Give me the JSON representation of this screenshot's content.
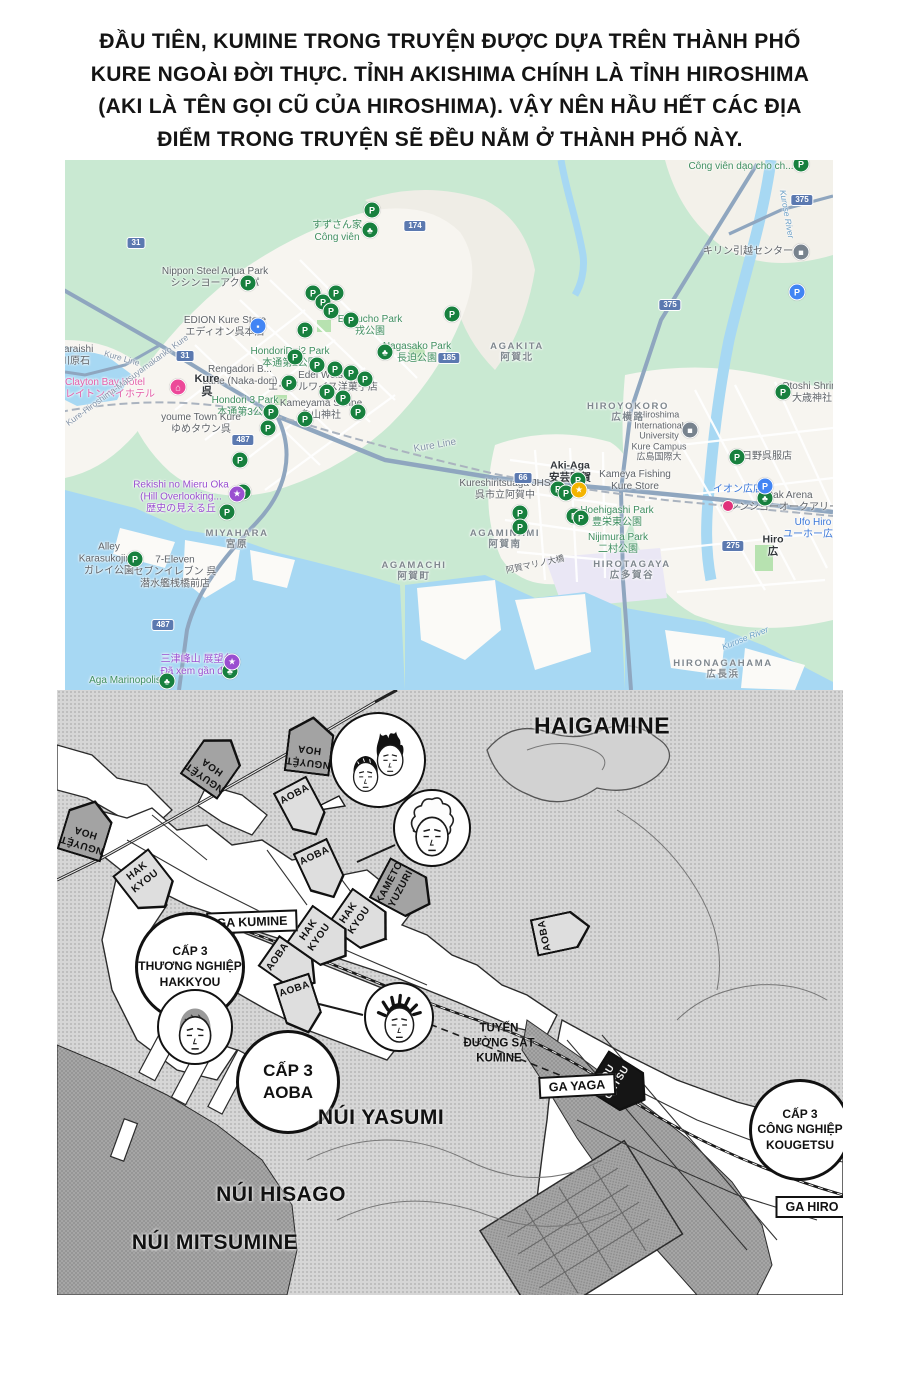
{
  "intro": {
    "lines": [
      "ĐẦU TIÊN, KUMINE TRONG TRUYỆN ĐƯỢC DỰA TRÊN THÀNH PHỐ",
      "KURE NGOÀI ĐỜI THỰC. TỈNH AKISHIMA CHÍNH LÀ TỈNH HIROSHIMA",
      "(AKI LÀ TÊN GỌI CŨ CỦA HIROSHIMA). VẬY NÊN HẦU HẾT CÁC ĐỊA",
      "ĐIỂM TRONG TRUYỆN SẼ ĐỀU NẰM Ở THÀNH PHỐ NÀY."
    ]
  },
  "gmap": {
    "colors": {
      "vegetation": "#c9e9d2",
      "water": "#a7d8f3",
      "urban": "#f7f5f0",
      "highway": "#8fa6bf",
      "park_pin": "#17803e",
      "visited": "#9a4fd0",
      "business": "#5f6368"
    },
    "pin_glyphs": {
      "p": "P",
      "tree": "♣",
      "star": "★",
      "lock": "▪",
      "hotel": "⌂",
      "gray": "■",
      "school": "■",
      "bp": "P",
      "mag": "",
      "purple": "★"
    },
    "labels": [
      {
        "x": 676,
        "y": 7,
        "c": "green",
        "lines": [
          "Công viên dạo cho ch..."
        ]
      },
      {
        "x": 272,
        "y": 72,
        "c": "green",
        "lines": [
          "すずさん家",
          "Công viên"
        ]
      },
      {
        "x": 150,
        "y": 118,
        "c": "gray",
        "lines": [
          "Nippon Steel Aqua Park",
          "シシンヨーアクアパ"
        ]
      },
      {
        "x": 160,
        "y": 167,
        "c": "gray",
        "lines": [
          "EDION Kure Store",
          "エディオン呉本店"
        ]
      },
      {
        "x": 305,
        "y": 166,
        "c": "green",
        "lines": [
          "Ebisucho Park",
          "戎公園"
        ]
      },
      {
        "x": 352,
        "y": 193,
        "c": "green",
        "lines": [
          "Nagasako Park",
          "長迫公園"
        ]
      },
      {
        "x": 225,
        "y": 198,
        "c": "green",
        "lines": [
          "HondoriDai2 Park",
          "本通第2公園"
        ]
      },
      {
        "x": 175,
        "y": 216,
        "c": "gray",
        "lines": [
          "Rengadori B...",
          "Lane (Naka-dori)"
        ]
      },
      {
        "x": 258,
        "y": 222,
        "c": "gray",
        "lines": [
          "Edel Weiss",
          "エーデルワイス洋菓子店"
        ]
      },
      {
        "x": 142,
        "y": 226,
        "c": "dark",
        "s": 11,
        "lines": [
          "Kure",
          "呉"
        ]
      },
      {
        "x": 40,
        "y": 229,
        "c": "pink",
        "lines": [
          "Clayton Bay Hotel",
          "クレイトンベイホテル"
        ]
      },
      {
        "x": 180,
        "y": 247,
        "c": "green",
        "lines": [
          "Hondori 3 Park",
          "本通第3公園"
        ]
      },
      {
        "x": 256,
        "y": 250,
        "c": "gray",
        "lines": [
          "Kameyama Shrine",
          "亀山神社"
        ]
      },
      {
        "x": 136,
        "y": 264,
        "c": "gray",
        "lines": [
          "youme Town Kure",
          "ゆめタウン呉"
        ]
      },
      {
        "x": 370,
        "y": 286,
        "r": -10,
        "c": "road",
        "lines": [
          "Kure Line"
        ]
      },
      {
        "x": 57,
        "y": 198,
        "r": 16,
        "c": "road",
        "s": 8.5,
        "lines": [
          "Kure Line"
        ]
      },
      {
        "x": 116,
        "y": 337,
        "c": "purple",
        "lines": [
          "Rekishi no Mieru Oka",
          "(Hill Overlooking...",
          "歴史の見える丘"
        ]
      },
      {
        "x": 172,
        "y": 379,
        "c": "area",
        "ls": 1,
        "lines": [
          "MIYAHARA",
          "宮原"
        ]
      },
      {
        "x": 44,
        "y": 399,
        "c": "gray",
        "lines": [
          "Alley",
          "Karasukojima",
          "ガレイ公園"
        ]
      },
      {
        "x": 110,
        "y": 412,
        "c": "gray",
        "lines": [
          "7-Eleven",
          "セブンイレブン 呉",
          "潜水艦桟橋前店"
        ]
      },
      {
        "x": 349,
        "y": 411,
        "c": "area",
        "ls": 1,
        "lines": [
          "AGAMACHI",
          "阿賀町"
        ]
      },
      {
        "x": 132,
        "y": 506,
        "c": "purple",
        "lines": [
          "三津峰山 展望台",
          "Đã xem gần đây"
        ]
      },
      {
        "x": 60,
        "y": 521,
        "c": "green",
        "lines": [
          "Aga Marinopolis"
        ]
      },
      {
        "x": 452,
        "y": 192,
        "c": "area",
        "ls": 1,
        "lines": [
          "AGAKITA",
          "阿賀北"
        ]
      },
      {
        "x": 683,
        "y": 92,
        "c": "gray",
        "lines": [
          "キリン引越センター"
        ]
      },
      {
        "x": 594,
        "y": 276,
        "c": "gray",
        "s": 9,
        "lines": [
          "Hiroshima",
          "International",
          "University",
          "Kure Campus",
          "広島国際大"
        ]
      },
      {
        "x": 505,
        "y": 312,
        "c": "dark",
        "s": 10.5,
        "lines": [
          "Aki-Aga",
          "安芸阿賀"
        ]
      },
      {
        "x": 440,
        "y": 330,
        "c": "gray",
        "lines": [
          "Kureshiritsuaga JHS",
          "呉市立阿賀中"
        ]
      },
      {
        "x": 570,
        "y": 321,
        "c": "gray",
        "lines": [
          "Kameya Fishing",
          "Kure Store"
        ]
      },
      {
        "x": 440,
        "y": 379,
        "c": "area",
        "ls": 1,
        "lines": [
          "AGAMINAMI",
          "阿賀南"
        ]
      },
      {
        "x": 552,
        "y": 357,
        "c": "green",
        "lines": [
          "Hoehigashi Park",
          "豊栄東公園"
        ]
      },
      {
        "x": 553,
        "y": 384,
        "c": "green",
        "lines": [
          "Nijimura Park",
          "二村公園"
        ]
      },
      {
        "x": 567,
        "y": 410,
        "c": "area",
        "ls": 1,
        "lines": [
          "HIROTAGAYA",
          "広多賀谷"
        ]
      },
      {
        "x": 702,
        "y": 297,
        "c": "gray",
        "lines": [
          "日野呉服店"
        ]
      },
      {
        "x": 673,
        "y": 330,
        "c": "blue",
        "lines": [
          "イオン広店"
        ]
      },
      {
        "x": 724,
        "y": 342,
        "c": "gray",
        "lines": [
          "Oak Arena",
          "シンシヨーオークアリーナ"
        ]
      },
      {
        "x": 748,
        "y": 369,
        "c": "blue",
        "lines": [
          "Ufo Hiro",
          "ユーホー広店"
        ]
      },
      {
        "x": 708,
        "y": 386,
        "c": "dark",
        "s": 10.5,
        "lines": [
          "Hiro",
          "広"
        ]
      },
      {
        "x": 747,
        "y": 233,
        "c": "gray",
        "lines": [
          "Otoshi Shrine",
          "大歳神社"
        ]
      },
      {
        "x": 563,
        "y": 252,
        "c": "area",
        "ls": 1,
        "lines": [
          "HIROYOKORO",
          "広横路"
        ]
      },
      {
        "x": 658,
        "y": 509,
        "c": "area",
        "ls": 1,
        "lines": [
          "HIRONAGAHAMA",
          "広長浜"
        ]
      },
      {
        "x": 10,
        "y": 196,
        "c": "gray",
        "lines": [
          "waraishi",
          "川原石"
        ]
      },
      {
        "x": 62,
        "y": 220,
        "r": -36,
        "c": "road",
        "s": 8.5,
        "lines": [
          "Kure-Hiroshima-Matsuyamakanko Kure"
        ]
      },
      {
        "x": 470,
        "y": 404,
        "r": -12,
        "c": "gray",
        "s": 8.5,
        "lines": [
          "阿賀マリノ大橋"
        ]
      },
      {
        "x": 722,
        "y": 54,
        "r": 80,
        "c": "waterl",
        "s": 8.5,
        "lines": [
          "Kurose River"
        ]
      },
      {
        "x": 680,
        "y": 478,
        "r": -22,
        "c": "waterl",
        "s": 8.5,
        "lines": [
          "Kurose River"
        ]
      }
    ],
    "pins": [
      {
        "t": "p",
        "x": 183,
        "y": 123
      },
      {
        "t": "p",
        "x": 736,
        "y": 4
      },
      {
        "t": "p",
        "x": 307,
        "y": 50
      },
      {
        "t": "p",
        "x": 248,
        "y": 133
      },
      {
        "t": "p",
        "x": 258,
        "y": 142
      },
      {
        "t": "p",
        "x": 266,
        "y": 151
      },
      {
        "t": "p",
        "x": 271,
        "y": 133
      },
      {
        "t": "p",
        "x": 286,
        "y": 160
      },
      {
        "t": "p",
        "x": 240,
        "y": 170
      },
      {
        "t": "p",
        "x": 230,
        "y": 197
      },
      {
        "t": "p",
        "x": 252,
        "y": 205
      },
      {
        "t": "p",
        "x": 270,
        "y": 209
      },
      {
        "t": "p",
        "x": 286,
        "y": 213
      },
      {
        "t": "p",
        "x": 300,
        "y": 219
      },
      {
        "t": "p",
        "x": 224,
        "y": 223
      },
      {
        "t": "p",
        "x": 262,
        "y": 232
      },
      {
        "t": "p",
        "x": 278,
        "y": 238
      },
      {
        "t": "p",
        "x": 206,
        "y": 252
      },
      {
        "t": "p",
        "x": 240,
        "y": 259
      },
      {
        "t": "p",
        "x": 293,
        "y": 252
      },
      {
        "t": "p",
        "x": 203,
        "y": 268
      },
      {
        "t": "p",
        "x": 175,
        "y": 300
      },
      {
        "t": "p",
        "x": 178,
        "y": 332
      },
      {
        "t": "p",
        "x": 162,
        "y": 352
      },
      {
        "t": "p",
        "x": 70,
        "y": 399
      },
      {
        "t": "p",
        "x": 387,
        "y": 154
      },
      {
        "t": "p",
        "x": 513,
        "y": 320
      },
      {
        "t": "p",
        "x": 493,
        "y": 329
      },
      {
        "t": "p",
        "x": 501,
        "y": 333
      },
      {
        "t": "p",
        "x": 455,
        "y": 353
      },
      {
        "t": "p",
        "x": 455,
        "y": 367
      },
      {
        "t": "p",
        "x": 509,
        "y": 356
      },
      {
        "t": "p",
        "x": 516,
        "y": 358
      },
      {
        "t": "p",
        "x": 672,
        "y": 297
      },
      {
        "t": "p",
        "x": 718,
        "y": 232
      },
      {
        "t": "tree",
        "x": 305,
        "y": 70
      },
      {
        "t": "tree",
        "x": 320,
        "y": 192
      },
      {
        "t": "tree",
        "x": 700,
        "y": 338
      },
      {
        "t": "tree",
        "x": 102,
        "y": 521
      },
      {
        "t": "tree",
        "x": 165,
        "y": 511
      },
      {
        "t": "star",
        "x": 514,
        "y": 330
      },
      {
        "t": "lock",
        "x": 193,
        "y": 166
      },
      {
        "t": "hotel",
        "x": 113,
        "y": 227
      },
      {
        "t": "gray",
        "x": 736,
        "y": 92
      },
      {
        "t": "school",
        "x": 625,
        "y": 270
      },
      {
        "t": "bp",
        "x": 700,
        "y": 326
      },
      {
        "t": "bp",
        "x": 732,
        "y": 132
      },
      {
        "t": "mag",
        "x": 663,
        "y": 346
      },
      {
        "t": "purple",
        "x": 172,
        "y": 334
      },
      {
        "t": "purple",
        "x": 167,
        "y": 502
      }
    ],
    "shields": [
      {
        "n": "31",
        "x": 71,
        "y": 83
      },
      {
        "n": "174",
        "x": 350,
        "y": 66
      },
      {
        "n": "375",
        "x": 737,
        "y": 40
      },
      {
        "n": "375",
        "x": 605,
        "y": 145
      },
      {
        "n": "185",
        "x": 384,
        "y": 198
      },
      {
        "n": "31",
        "x": 120,
        "y": 196
      },
      {
        "n": "487",
        "x": 178,
        "y": 280
      },
      {
        "n": "487",
        "x": 98,
        "y": 465
      },
      {
        "n": "275",
        "x": 668,
        "y": 386
      },
      {
        "n": "66",
        "x": 458,
        "y": 318
      }
    ]
  },
  "manga": {
    "mountains": [
      {
        "text": "HAIGAMINE",
        "x": 545,
        "y": 36,
        "s": 23
      },
      {
        "text": "NÚI YASUMI",
        "x": 324,
        "y": 428,
        "s": 21
      },
      {
        "text": "NÚI HISAGO",
        "x": 224,
        "y": 505,
        "s": 21
      },
      {
        "text": "NÚI MITSUMINE",
        "x": 158,
        "y": 553,
        "s": 21
      }
    ],
    "pennants": [
      {
        "lines": [
          "NGUYỆT",
          "HOA"
        ],
        "x": 253,
        "y": 55,
        "rot": 187,
        "tone": "mid"
      },
      {
        "lines": [
          "NGUYỆT",
          "HOA"
        ],
        "x": 158,
        "y": 73,
        "rot": 215,
        "tone": "mid"
      },
      {
        "lines": [
          "NGUYỆT",
          "HOA"
        ],
        "x": 30,
        "y": 138,
        "rot": 197,
        "tone": "mid"
      },
      {
        "lines": [
          "AOBA"
        ],
        "x": 246,
        "y": 120,
        "rot": -28,
        "tone": "light"
      },
      {
        "lines": [
          "AOBA"
        ],
        "x": 265,
        "y": 182,
        "rot": -25,
        "tone": "light"
      },
      {
        "lines": [
          "AOBA"
        ],
        "x": 505,
        "y": 242,
        "rot": 258,
        "tone": "light"
      },
      {
        "lines": [
          "AOBA"
        ],
        "x": 235,
        "y": 277,
        "rot": -55,
        "tone": "light"
      },
      {
        "lines": [
          "AOBA"
        ],
        "x": 243,
        "y": 316,
        "rot": -18,
        "tone": "light"
      },
      {
        "lines": [
          "HAK",
          "KYOU"
        ],
        "x": 91,
        "y": 195,
        "rot": -38,
        "tone": "light"
      },
      {
        "lines": [
          "HAK",
          "KYOU"
        ],
        "x": 306,
        "y": 233,
        "rot": -55,
        "tone": "light"
      },
      {
        "lines": [
          "HAK",
          "KYOU"
        ],
        "x": 266,
        "y": 250,
        "rot": -55,
        "tone": "light"
      },
      {
        "lines": [
          "KAMETO",
          "YUZURI"
        ],
        "x": 348,
        "y": 201,
        "rot": -62,
        "tone": "mid"
      },
      {
        "lines": [
          "KOU",
          "GETSU"
        ],
        "x": 564,
        "y": 395,
        "rot": -58,
        "tone": "black"
      }
    ],
    "signs": [
      {
        "text": "GA KUMINE",
        "x": 195,
        "y": 232,
        "rot": -2
      },
      {
        "text": "GA YAGA",
        "x": 520,
        "y": 396,
        "rot": -3
      },
      {
        "text": "GA HIRO",
        "x": 755,
        "y": 517,
        "rot": 0
      }
    ],
    "schools": [
      {
        "lines": [
          "CẤP 3",
          "THƯƠNG NGHIỆP",
          "HAKKYOU"
        ],
        "x": 133,
        "y": 277,
        "r": 52,
        "fs": 12
      },
      {
        "lines": [
          "CẤP 3",
          "AOBA"
        ],
        "x": 231,
        "y": 392,
        "r": 49,
        "fs": 17
      },
      {
        "lines": [
          "CẤP 3",
          "CÔNG NGHIỆP",
          "KOUGETSU"
        ],
        "x": 743,
        "y": 440,
        "r": 48,
        "fs": 12
      }
    ],
    "note": {
      "lines": [
        "TUYẾN",
        "ĐƯỜNG SẮT",
        "KUMINE"
      ],
      "x": 442,
      "y": 354
    },
    "faces": [
      {
        "variant": "duo",
        "x": 321,
        "y": 70,
        "r": 46
      },
      {
        "variant": "curly",
        "x": 375,
        "y": 138,
        "r": 37
      },
      {
        "variant": "buzz",
        "x": 138,
        "y": 337,
        "r": 36
      },
      {
        "variant": "dreads",
        "x": 342,
        "y": 327,
        "r": 33
      }
    ]
  }
}
